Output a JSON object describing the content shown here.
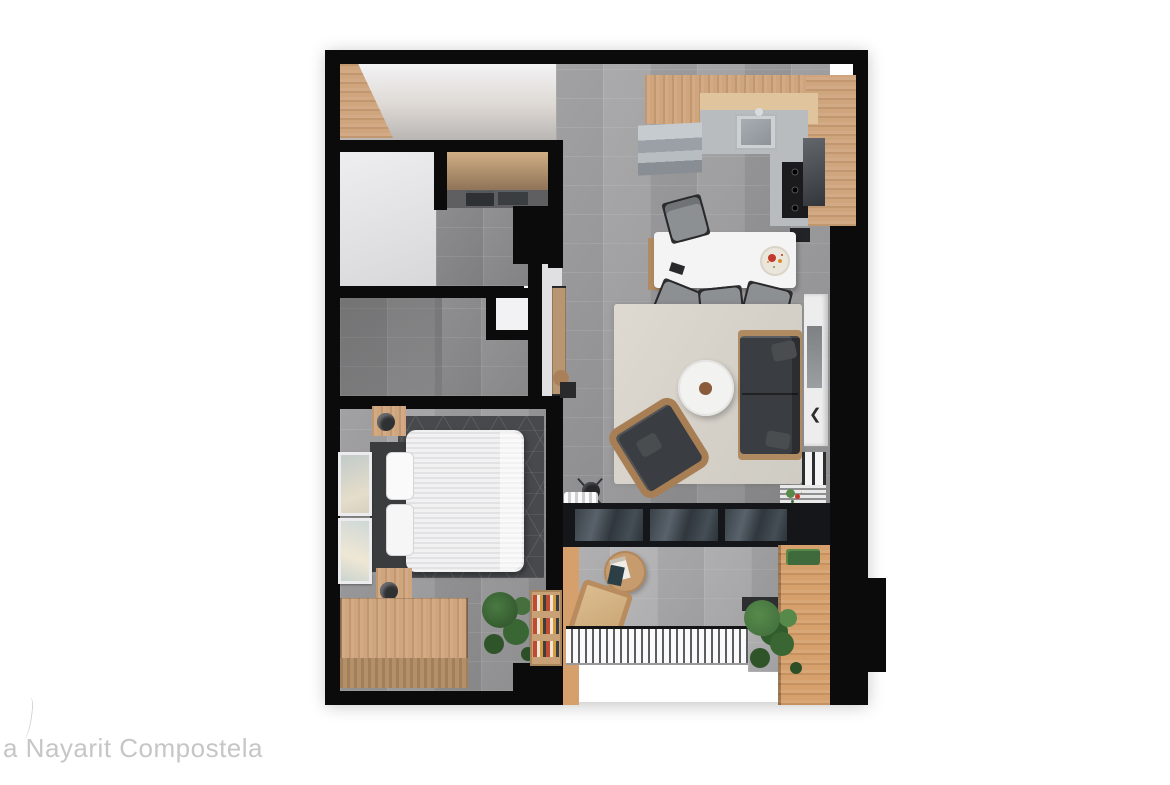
{
  "watermark": {
    "label": "a Nayarit Compostela"
  },
  "palette": {
    "background": "#ffffff",
    "wall": "#0b0b0b",
    "tile": "#9f9fa1",
    "tile_dark": "#8e8e90",
    "tile_light": "#b2b2b4",
    "tile_bath": "#98989a",
    "wood": "#cfa57d",
    "wood_light": "#e0c49e",
    "wood_dark": "#b08a61",
    "wood_balcony": "#d5a06c",
    "rug_bedroom": "#47494c",
    "sofa": "#3a3d41",
    "sofa_pillow": "#4a4d50",
    "chair_gray": "#8d9093",
    "headboard": "#3a3c3e",
    "counter": "#b9bcbe",
    "stove": "#1b1b1d",
    "appliance": "#222326",
    "door_frame": "#141619",
    "plant_dark": "#3f6b3c",
    "plant_light": "#578a4a",
    "fruit_red": "#c0392b",
    "fruit_orange": "#d98e2b",
    "watermark": "#c6c6c6"
  },
  "scene": {
    "type": "3d-floorplan-render",
    "rooms": [
      "entry-corridor",
      "bathroom-1",
      "laundry-closet",
      "bathroom-2",
      "hallway",
      "kitchen",
      "dining-area",
      "living-room",
      "bedroom",
      "balcony"
    ],
    "furniture": [
      "kitchen-sink",
      "gas-stove",
      "fridge",
      "dishwasher",
      "dining-table",
      "dining-chairs",
      "fruit-bowl",
      "area-rug",
      "sofa",
      "armchair",
      "round-coffee-table",
      "tv-console",
      "sliding-glass-door",
      "curtain",
      "standing-fan",
      "double-bed",
      "nightstands",
      "lamps",
      "wall-art",
      "storage-bench",
      "bookshelf",
      "plants",
      "toilet",
      "vanity-sink",
      "washer-dryer",
      "balcony-table",
      "balcony-chair",
      "deck-railing"
    ]
  },
  "chevron_glyph": "❮"
}
